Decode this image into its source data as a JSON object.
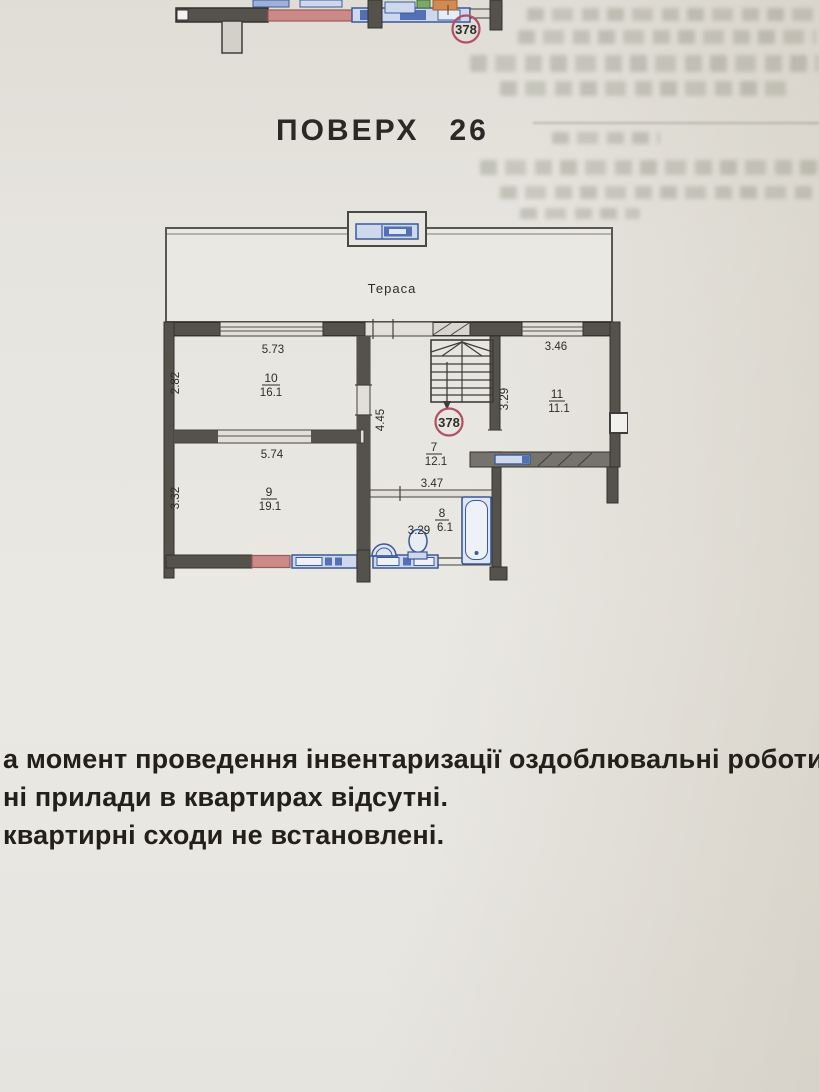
{
  "title": {
    "label": "ПОВЕРХ",
    "number": "26"
  },
  "top_plan": {
    "stamp_number": "378"
  },
  "plan": {
    "terrace_label": "Тераса",
    "stamp_number": "378",
    "rooms": [
      {
        "number": "10",
        "area": "16.1"
      },
      {
        "number": "9",
        "area": "19.1"
      },
      {
        "number": "7",
        "area": "12.1"
      },
      {
        "number": "8",
        "area": "6.1"
      },
      {
        "number": "11",
        "area": "11.1"
      }
    ],
    "dims": {
      "room10_w": "5.73",
      "room10_h": "2.82",
      "room9_w": "5.74",
      "room9_h": "3.32",
      "corridor_h": "4.45",
      "corridor_w": "3.47",
      "bath_w": "3.29",
      "room11_w": "3.46",
      "room11_h": "3.29"
    },
    "colors": {
      "stamp_red": "#b34f62",
      "fixture_blue": "#3a5a9a",
      "wall_dark": "#55524c",
      "accent_pink": "#cb8a87"
    }
  },
  "notes": {
    "lines": [
      "а момент проведення інвентаризації оздоблювальні роботи",
      "ні прилади в квартирах відсутні.",
      "квартирні сходи не встановлені."
    ]
  }
}
